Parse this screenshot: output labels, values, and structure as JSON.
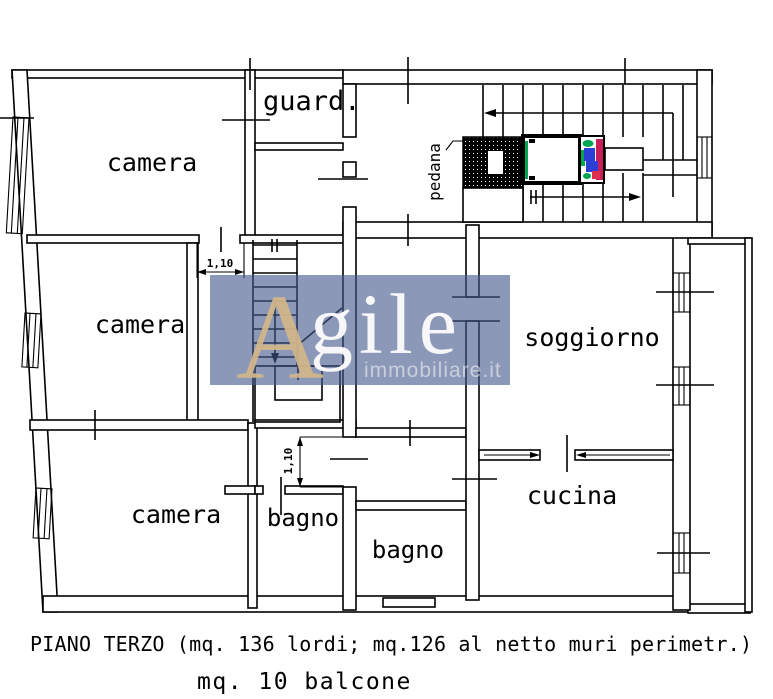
{
  "plan": {
    "rooms": [
      {
        "id": "camera-1",
        "label": "camera"
      },
      {
        "id": "guardaroba",
        "label": "guard."
      },
      {
        "id": "camera-2",
        "label": "camera"
      },
      {
        "id": "camera-3",
        "label": "camera"
      },
      {
        "id": "bagno-1",
        "label": "bagno"
      },
      {
        "id": "bagno-2",
        "label": "bagno"
      },
      {
        "id": "soggiorno",
        "label": "soggiorno"
      },
      {
        "id": "cucina",
        "label": "cucina"
      }
    ],
    "annotations": {
      "pedana": "pedana",
      "dim_door_h": "1,10",
      "dim_door_v": "1,10"
    }
  },
  "watermark": {
    "letter_a": "A",
    "rest": "gile",
    "tagline": "immobiliare.it",
    "bg_color": "#5a6c9a",
    "a_color": "#d3b78a",
    "text_color": "#f7f7fa"
  },
  "caption": {
    "line1": "PIANO TERZO (mq. 136 lordi; mq.126 al netto muri perimetr.)",
    "line2": "mq. 10 balcone"
  },
  "colors": {
    "line": "#000000",
    "lift_green": "#00a651",
    "lift_blue": "#2c3ed6",
    "lift_crimson": "#c81e5a",
    "lift_red": "#e03050"
  }
}
